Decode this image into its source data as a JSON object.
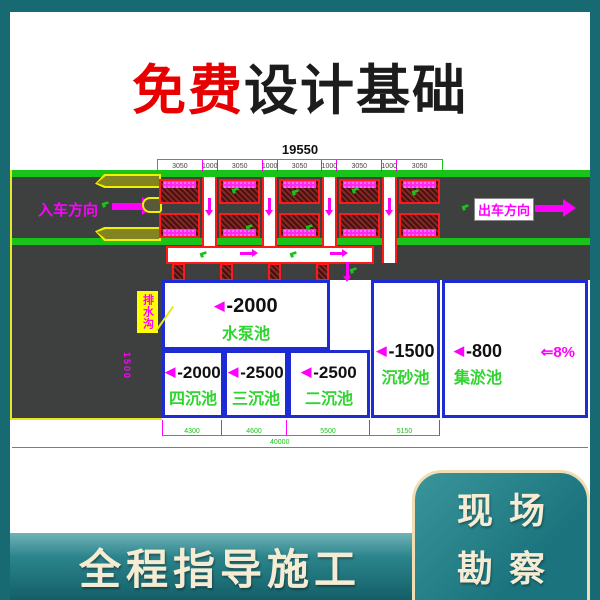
{
  "top_banner": {
    "highlight": "免费",
    "title": "设计基础"
  },
  "drawing": {
    "total_dim_top": "19550",
    "top_segments": [
      "3050",
      "1000",
      "3050",
      "1000",
      "3050",
      "1000",
      "3050",
      "1000",
      "3050"
    ],
    "entry_label": "入车方向",
    "exit_label": "出车方向",
    "callout_label": "排水沟",
    "callout_dim": "1500",
    "pools": [
      {
        "level": "-2000",
        "name": "水泵池"
      },
      {
        "level": "-2000",
        "name": "四沉池"
      },
      {
        "level": "-2500",
        "name": "三沉池"
      },
      {
        "level": "-2500",
        "name": "二沉池"
      },
      {
        "level": "-1500",
        "name": "沉砂池"
      },
      {
        "level": "-800",
        "name": "集淤池"
      }
    ],
    "slope_label": "⇐8%",
    "bottom_segments": [
      "4300",
      "4600",
      "5500",
      "5150"
    ],
    "total_dim_bottom": "40000",
    "level_prefix": "◀"
  },
  "bottom_banner": {
    "title": "全程指导施工"
  },
  "corner_badge": {
    "line1": "现场",
    "line2": "勘察"
  },
  "colors": {
    "frame_teal": "#186a72",
    "banner_cream": "#f6ecd4",
    "highlight_red": "#e80000",
    "cad_green": "#17c417",
    "cad_magenta": "#ff00ff",
    "pool_blue": "#1c2bd4",
    "road_gray": "#3e4040",
    "hatch_red": "#822926",
    "island_yellow": "#f0f000"
  }
}
